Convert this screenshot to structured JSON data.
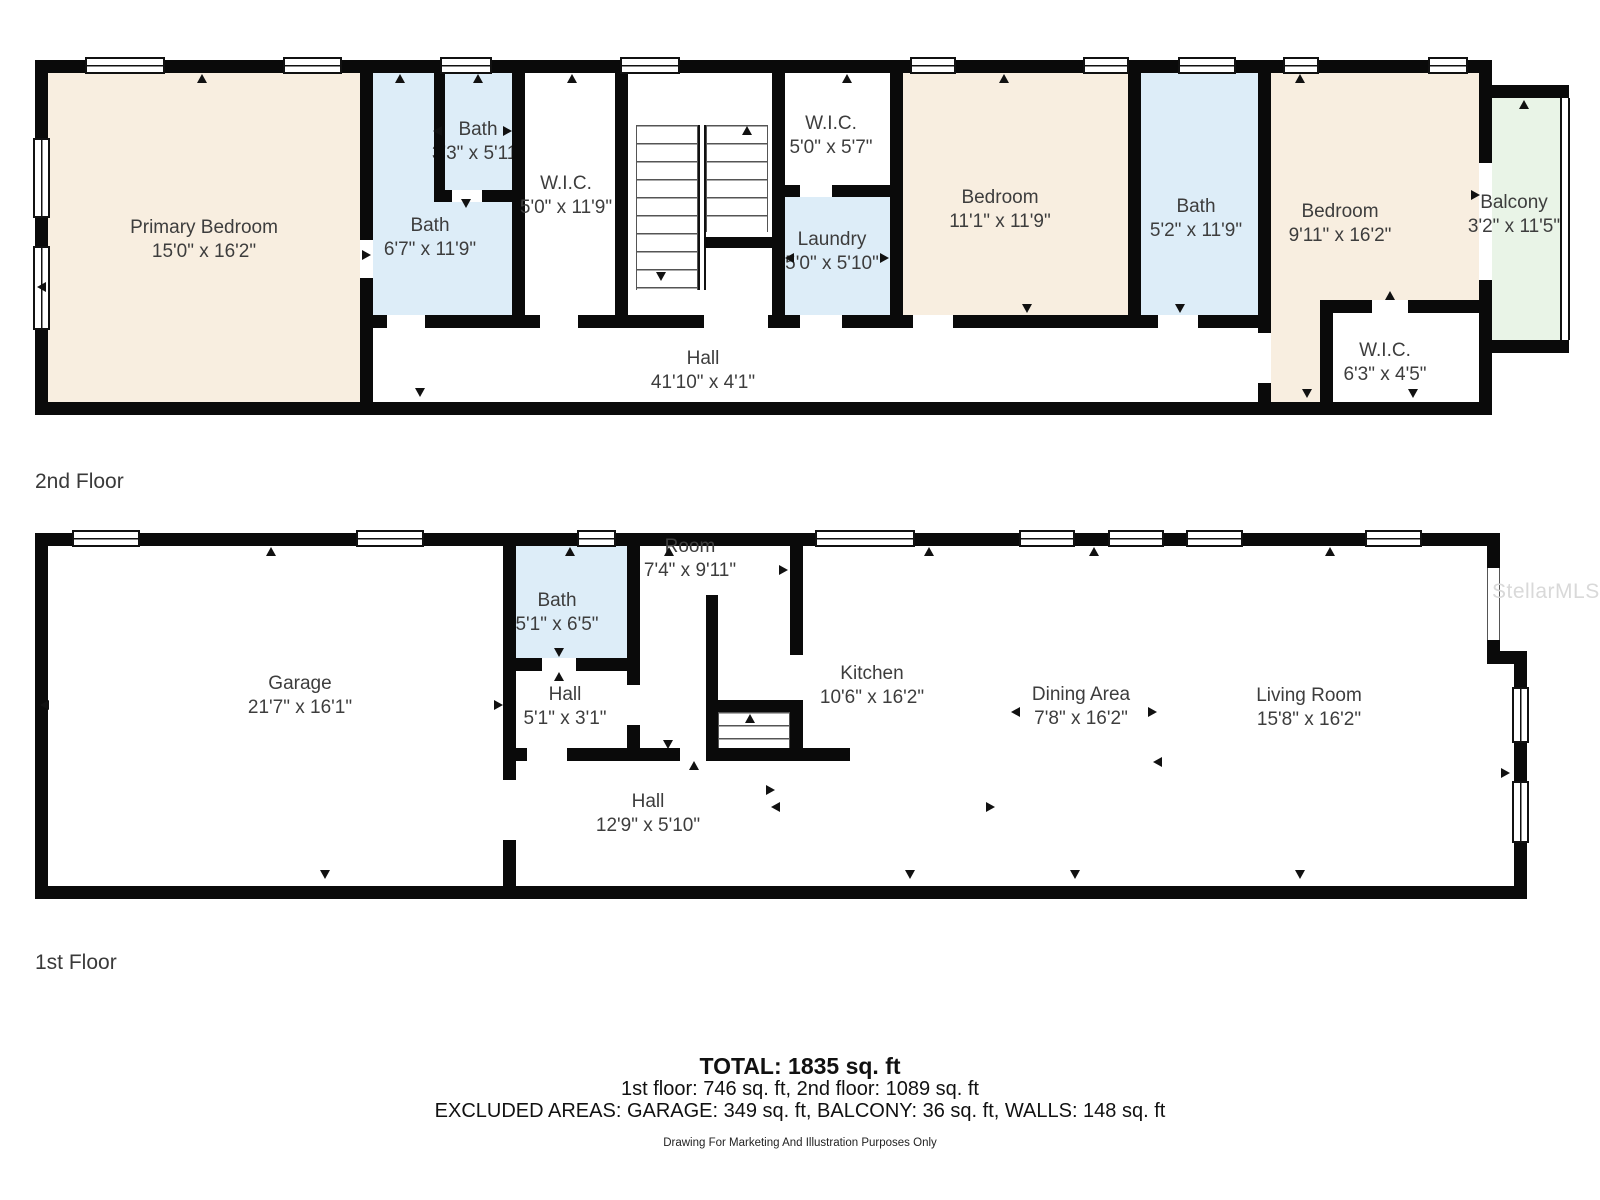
{
  "watermark": "StellarMLS",
  "colors": {
    "wall": "#0a0a0a",
    "bedroom_fill": "#f8eee0",
    "bath_fill": "#ddedf8",
    "balcony_fill": "#e9f4e7",
    "label_text": "#3d3d3d",
    "watermark_text": "#d9d9d9"
  },
  "floor2": {
    "label": "2nd Floor",
    "rooms": {
      "primary": {
        "name": "Primary Bedroom",
        "dims": "15'0\" x 16'2\""
      },
      "bath_main": {
        "name": "Bath",
        "dims": "6'7\" x 11'9\""
      },
      "bath_small": {
        "name": "Bath",
        "dims": "3'3\" x 5'11\""
      },
      "wic_left": {
        "name": "W.I.C.",
        "dims": "5'0\" x 11'9\""
      },
      "wic_mid": {
        "name": "W.I.C.",
        "dims": "5'0\" x 5'7\""
      },
      "laundry": {
        "name": "Laundry",
        "dims": "5'0\" x 5'10\""
      },
      "bedroom_mid": {
        "name": "Bedroom",
        "dims": "11'1\" x 11'9\""
      },
      "bath_right": {
        "name": "Bath",
        "dims": "5'2\" x 11'9\""
      },
      "bedroom_right": {
        "name": "Bedroom",
        "dims": "9'11\" x 16'2\""
      },
      "wic_right": {
        "name": "W.I.C.",
        "dims": "6'3\" x 4'5\""
      },
      "hall": {
        "name": "Hall",
        "dims": "41'10\" x 4'1\""
      },
      "balcony": {
        "name": "Balcony",
        "dims": "3'2\" x 11'5\""
      }
    }
  },
  "floor1": {
    "label": "1st Floor",
    "rooms": {
      "garage": {
        "name": "Garage",
        "dims": "21'7\" x 16'1\""
      },
      "bath": {
        "name": "Bath",
        "dims": "5'1\" x 6'5\""
      },
      "hall_small": {
        "name": "Hall",
        "dims": "5'1\" x 3'1\""
      },
      "room": {
        "name": "Room",
        "dims": "7'4\" x 9'11\""
      },
      "kitchen": {
        "name": "Kitchen",
        "dims": "10'6\" x 16'2\""
      },
      "dining": {
        "name": "Dining Area",
        "dims": "7'8\" x 16'2\""
      },
      "living": {
        "name": "Living Room",
        "dims": "15'8\" x 16'2\""
      },
      "hall": {
        "name": "Hall",
        "dims": "12'9\" x 5'10\""
      }
    }
  },
  "footer": {
    "total": "TOTAL: 1835 sq. ft",
    "floors": "1st floor: 746 sq. ft, 2nd floor: 1089 sq. ft",
    "excluded": "EXCLUDED AREAS: GARAGE: 349 sq. ft, BALCONY: 36 sq. ft, WALLS: 148 sq. ft",
    "disclaimer": "Drawing For Marketing And Illustration Purposes Only"
  }
}
